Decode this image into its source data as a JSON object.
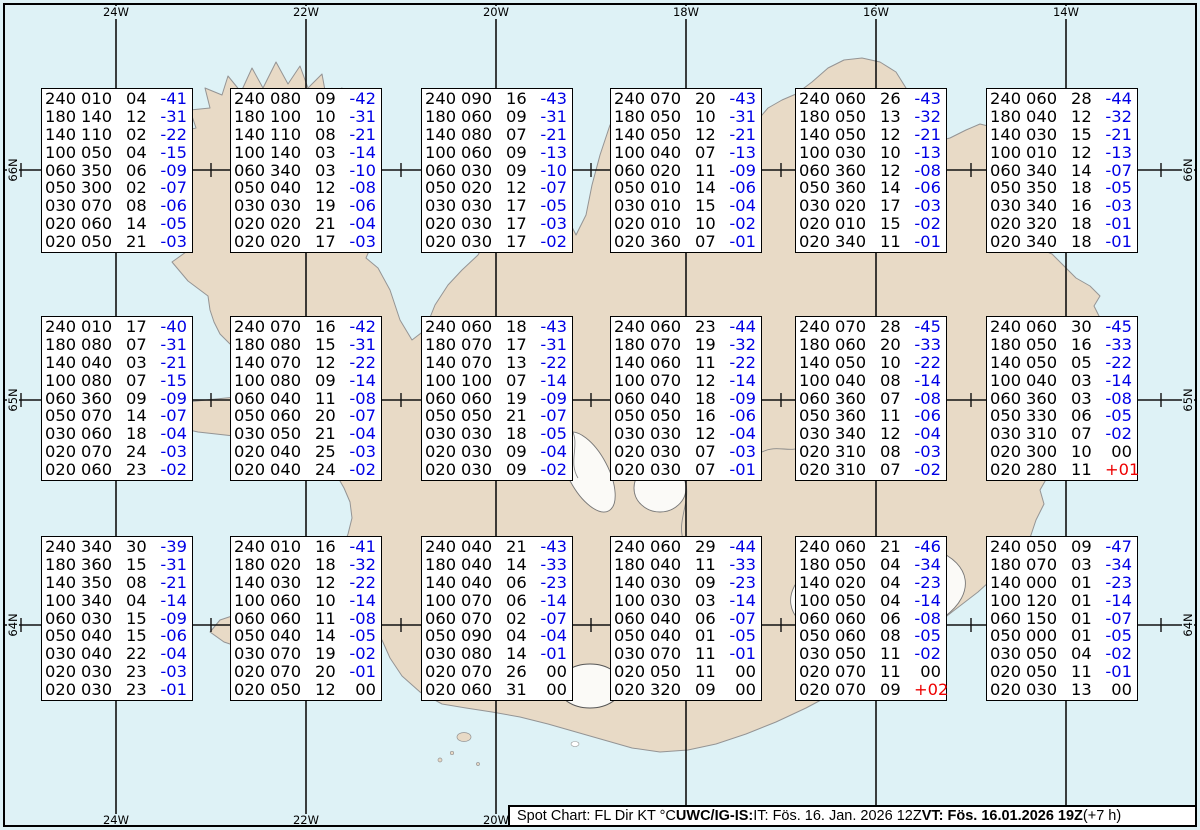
{
  "grid": {
    "lon_labels": [
      "24W",
      "22W",
      "20W",
      "18W",
      "16W",
      "14W"
    ],
    "lat_labels": [
      "66N",
      "65N",
      "64N"
    ]
  },
  "info_bar": {
    "segments": [
      {
        "text": "Spot Chart: FL Dir KT °C ",
        "bold": false
      },
      {
        "text": "UWC/IG-IS:",
        "bold": true
      },
      {
        "text": " IT: Fös. 16. Jan. 2026 12Z ",
        "bold": false
      },
      {
        "text": "VT: Fös. 16.01.2026 19Z",
        "bold": true
      },
      {
        "text": " (+7 h)",
        "bold": false
      }
    ]
  },
  "colors": {
    "ocean": "#def2f6",
    "land": "#e8dac6",
    "coast": "#949494",
    "grid_line": "#111111",
    "box_border": "#000000",
    "temp_negative": "#0000e6",
    "temp_positive": "#ee0000",
    "value_text": "#000000"
  },
  "spot_boxes": [
    {
      "rows": [
        [
          "240",
          "010",
          "04",
          "-41"
        ],
        [
          "180",
          "140",
          "12",
          "-31"
        ],
        [
          "140",
          "110",
          "02",
          "-22"
        ],
        [
          "100",
          "050",
          "04",
          "-15"
        ],
        [
          "060",
          "350",
          "06",
          "-09"
        ],
        [
          "050",
          "300",
          "02",
          "-07"
        ],
        [
          "030",
          "070",
          "08",
          "-06"
        ],
        [
          "020",
          "060",
          "14",
          "-05"
        ],
        [
          "020",
          "050",
          "21",
          "-03"
        ]
      ]
    },
    {
      "rows": [
        [
          "240",
          "080",
          "09",
          "-42"
        ],
        [
          "180",
          "100",
          "10",
          "-31"
        ],
        [
          "140",
          "110",
          "08",
          "-21"
        ],
        [
          "100",
          "140",
          "03",
          "-14"
        ],
        [
          "060",
          "340",
          "03",
          "-10"
        ],
        [
          "050",
          "040",
          "12",
          "-08"
        ],
        [
          "030",
          "030",
          "19",
          "-06"
        ],
        [
          "020",
          "020",
          "21",
          "-04"
        ],
        [
          "020",
          "020",
          "17",
          "-03"
        ]
      ]
    },
    {
      "rows": [
        [
          "240",
          "090",
          "16",
          "-43"
        ],
        [
          "180",
          "060",
          "09",
          "-31"
        ],
        [
          "140",
          "080",
          "07",
          "-21"
        ],
        [
          "100",
          "060",
          "09",
          "-13"
        ],
        [
          "060",
          "030",
          "09",
          "-10"
        ],
        [
          "050",
          "020",
          "12",
          "-07"
        ],
        [
          "030",
          "030",
          "17",
          "-05"
        ],
        [
          "020",
          "030",
          "17",
          "-03"
        ],
        [
          "020",
          "030",
          "17",
          "-02"
        ]
      ]
    },
    {
      "rows": [
        [
          "240",
          "070",
          "20",
          "-43"
        ],
        [
          "180",
          "050",
          "10",
          "-31"
        ],
        [
          "140",
          "050",
          "12",
          "-21"
        ],
        [
          "100",
          "040",
          "07",
          "-13"
        ],
        [
          "060",
          "020",
          "11",
          "-09"
        ],
        [
          "050",
          "010",
          "14",
          "-06"
        ],
        [
          "030",
          "010",
          "15",
          "-04"
        ],
        [
          "020",
          "010",
          "10",
          "-02"
        ],
        [
          "020",
          "360",
          "07",
          "-01"
        ]
      ]
    },
    {
      "rows": [
        [
          "240",
          "060",
          "26",
          "-43"
        ],
        [
          "180",
          "050",
          "13",
          "-32"
        ],
        [
          "140",
          "050",
          "12",
          "-21"
        ],
        [
          "100",
          "030",
          "10",
          "-13"
        ],
        [
          "060",
          "360",
          "12",
          "-08"
        ],
        [
          "050",
          "360",
          "14",
          "-06"
        ],
        [
          "030",
          "020",
          "17",
          "-03"
        ],
        [
          "020",
          "010",
          "15",
          "-02"
        ],
        [
          "020",
          "340",
          "11",
          "-01"
        ]
      ]
    },
    {
      "rows": [
        [
          "240",
          "060",
          "28",
          "-44"
        ],
        [
          "180",
          "040",
          "12",
          "-32"
        ],
        [
          "140",
          "030",
          "15",
          "-21"
        ],
        [
          "100",
          "010",
          "12",
          "-13"
        ],
        [
          "060",
          "340",
          "14",
          "-07"
        ],
        [
          "050",
          "350",
          "18",
          "-05"
        ],
        [
          "030",
          "340",
          "16",
          "-03"
        ],
        [
          "020",
          "320",
          "18",
          "-01"
        ],
        [
          "020",
          "340",
          "18",
          "-01"
        ]
      ]
    },
    {
      "rows": [
        [
          "240",
          "010",
          "17",
          "-40"
        ],
        [
          "180",
          "080",
          "07",
          "-31"
        ],
        [
          "140",
          "040",
          "03",
          "-21"
        ],
        [
          "100",
          "080",
          "07",
          "-15"
        ],
        [
          "060",
          "360",
          "09",
          "-09"
        ],
        [
          "050",
          "070",
          "14",
          "-07"
        ],
        [
          "030",
          "060",
          "18",
          "-04"
        ],
        [
          "020",
          "070",
          "24",
          "-03"
        ],
        [
          "020",
          "060",
          "23",
          "-02"
        ]
      ]
    },
    {
      "rows": [
        [
          "240",
          "070",
          "16",
          "-42"
        ],
        [
          "180",
          "080",
          "15",
          "-31"
        ],
        [
          "140",
          "070",
          "12",
          "-22"
        ],
        [
          "100",
          "080",
          "09",
          "-14"
        ],
        [
          "060",
          "040",
          "11",
          "-08"
        ],
        [
          "050",
          "060",
          "20",
          "-07"
        ],
        [
          "030",
          "050",
          "21",
          "-04"
        ],
        [
          "020",
          "040",
          "25",
          "-03"
        ],
        [
          "020",
          "040",
          "24",
          "-02"
        ]
      ]
    },
    {
      "rows": [
        [
          "240",
          "060",
          "18",
          "-43"
        ],
        [
          "180",
          "070",
          "17",
          "-31"
        ],
        [
          "140",
          "070",
          "13",
          "-22"
        ],
        [
          "100",
          "100",
          "07",
          "-14"
        ],
        [
          "060",
          "060",
          "19",
          "-09"
        ],
        [
          "050",
          "050",
          "21",
          "-07"
        ],
        [
          "030",
          "030",
          "18",
          "-05"
        ],
        [
          "020",
          "030",
          "09",
          "-04"
        ],
        [
          "020",
          "030",
          "09",
          "-02"
        ]
      ]
    },
    {
      "rows": [
        [
          "240",
          "060",
          "23",
          "-44"
        ],
        [
          "180",
          "070",
          "19",
          "-32"
        ],
        [
          "140",
          "060",
          "11",
          "-22"
        ],
        [
          "100",
          "070",
          "12",
          "-14"
        ],
        [
          "060",
          "040",
          "18",
          "-09"
        ],
        [
          "050",
          "050",
          "16",
          "-06"
        ],
        [
          "030",
          "030",
          "12",
          "-04"
        ],
        [
          "020",
          "030",
          "07",
          "-03"
        ],
        [
          "020",
          "030",
          "07",
          "-01"
        ]
      ]
    },
    {
      "rows": [
        [
          "240",
          "070",
          "28",
          "-45"
        ],
        [
          "180",
          "060",
          "20",
          "-33"
        ],
        [
          "140",
          "050",
          "10",
          "-22"
        ],
        [
          "100",
          "040",
          "08",
          "-14"
        ],
        [
          "060",
          "360",
          "07",
          "-08"
        ],
        [
          "050",
          "360",
          "11",
          "-06"
        ],
        [
          "030",
          "340",
          "12",
          "-04"
        ],
        [
          "020",
          "310",
          "08",
          "-03"
        ],
        [
          "020",
          "310",
          "07",
          "-02"
        ]
      ]
    },
    {
      "rows": [
        [
          "240",
          "060",
          "30",
          "-45"
        ],
        [
          "180",
          "050",
          "16",
          "-33"
        ],
        [
          "140",
          "050",
          "05",
          "-22"
        ],
        [
          "100",
          "040",
          "03",
          "-14"
        ],
        [
          "060",
          "360",
          "03",
          "-08"
        ],
        [
          "050",
          "330",
          "06",
          "-05"
        ],
        [
          "030",
          "310",
          "07",
          "-02"
        ],
        [
          "020",
          "300",
          "10",
          "00"
        ],
        [
          "020",
          "280",
          "11",
          "+01"
        ]
      ]
    },
    {
      "rows": [
        [
          "240",
          "340",
          "30",
          "-39"
        ],
        [
          "180",
          "360",
          "15",
          "-31"
        ],
        [
          "140",
          "350",
          "08",
          "-21"
        ],
        [
          "100",
          "340",
          "04",
          "-14"
        ],
        [
          "060",
          "030",
          "15",
          "-09"
        ],
        [
          "050",
          "040",
          "15",
          "-06"
        ],
        [
          "030",
          "040",
          "22",
          "-04"
        ],
        [
          "020",
          "030",
          "23",
          "-03"
        ],
        [
          "020",
          "030",
          "23",
          "-01"
        ]
      ]
    },
    {
      "rows": [
        [
          "240",
          "010",
          "16",
          "-41"
        ],
        [
          "180",
          "020",
          "18",
          "-32"
        ],
        [
          "140",
          "030",
          "12",
          "-22"
        ],
        [
          "100",
          "060",
          "10",
          "-14"
        ],
        [
          "060",
          "060",
          "11",
          "-08"
        ],
        [
          "050",
          "040",
          "14",
          "-05"
        ],
        [
          "030",
          "070",
          "19",
          "-02"
        ],
        [
          "020",
          "070",
          "20",
          "-01"
        ],
        [
          "020",
          "050",
          "12",
          "00"
        ]
      ]
    },
    {
      "rows": [
        [
          "240",
          "040",
          "21",
          "-43"
        ],
        [
          "180",
          "040",
          "14",
          "-33"
        ],
        [
          "140",
          "040",
          "06",
          "-23"
        ],
        [
          "100",
          "070",
          "06",
          "-14"
        ],
        [
          "060",
          "070",
          "02",
          "-07"
        ],
        [
          "050",
          "090",
          "04",
          "-04"
        ],
        [
          "030",
          "080",
          "14",
          "-01"
        ],
        [
          "020",
          "070",
          "26",
          "00"
        ],
        [
          "020",
          "060",
          "31",
          "00"
        ]
      ]
    },
    {
      "rows": [
        [
          "240",
          "060",
          "29",
          "-44"
        ],
        [
          "180",
          "040",
          "11",
          "-33"
        ],
        [
          "140",
          "030",
          "09",
          "-23"
        ],
        [
          "100",
          "030",
          "03",
          "-14"
        ],
        [
          "060",
          "040",
          "06",
          "-07"
        ],
        [
          "050",
          "040",
          "01",
          "-05"
        ],
        [
          "030",
          "070",
          "11",
          "-01"
        ],
        [
          "020",
          "050",
          "11",
          "00"
        ],
        [
          "020",
          "320",
          "09",
          "00"
        ]
      ]
    },
    {
      "rows": [
        [
          "240",
          "060",
          "21",
          "-46"
        ],
        [
          "180",
          "050",
          "04",
          "-34"
        ],
        [
          "140",
          "020",
          "04",
          "-23"
        ],
        [
          "100",
          "050",
          "04",
          "-14"
        ],
        [
          "060",
          "060",
          "06",
          "-08"
        ],
        [
          "050",
          "060",
          "08",
          "-05"
        ],
        [
          "030",
          "050",
          "11",
          "-02"
        ],
        [
          "020",
          "070",
          "11",
          "00"
        ],
        [
          "020",
          "070",
          "09",
          "+02"
        ]
      ]
    },
    {
      "rows": [
        [
          "240",
          "050",
          "09",
          "-47"
        ],
        [
          "180",
          "070",
          "03",
          "-34"
        ],
        [
          "140",
          "000",
          "01",
          "-23"
        ],
        [
          "100",
          "120",
          "01",
          "-14"
        ],
        [
          "060",
          "150",
          "01",
          "-07"
        ],
        [
          "050",
          "000",
          "01",
          "-05"
        ],
        [
          "030",
          "050",
          "04",
          "-02"
        ],
        [
          "020",
          "050",
          "11",
          "-01"
        ],
        [
          "020",
          "030",
          "13",
          "00"
        ]
      ]
    }
  ]
}
